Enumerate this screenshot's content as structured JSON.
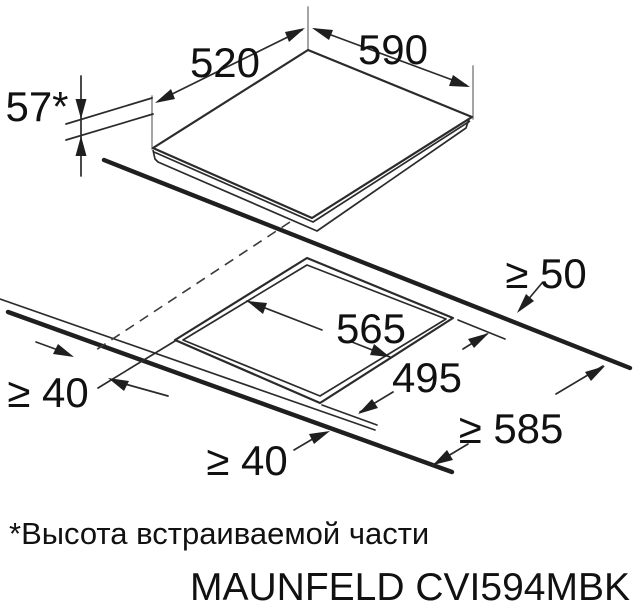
{
  "diagram": {
    "dimensions": {
      "cooktop_depth": "520",
      "cooktop_width": "590",
      "built_in_height": "57*",
      "clearance_back": "≥ 50",
      "cutout_width": "565",
      "cutout_depth": "495",
      "clearance_left": "≥ 40",
      "clearance_front": "≥ 40",
      "worktop_min_width": "≥ 585"
    },
    "footnote": "*Высота встраиваемой части",
    "model": "MAUNFELD CVI594MBK",
    "colors": {
      "line": "#2b2b2b",
      "thick_line": "#1f1f1f",
      "witness_line": "#9b9b9b",
      "background": "#ffffff"
    }
  }
}
